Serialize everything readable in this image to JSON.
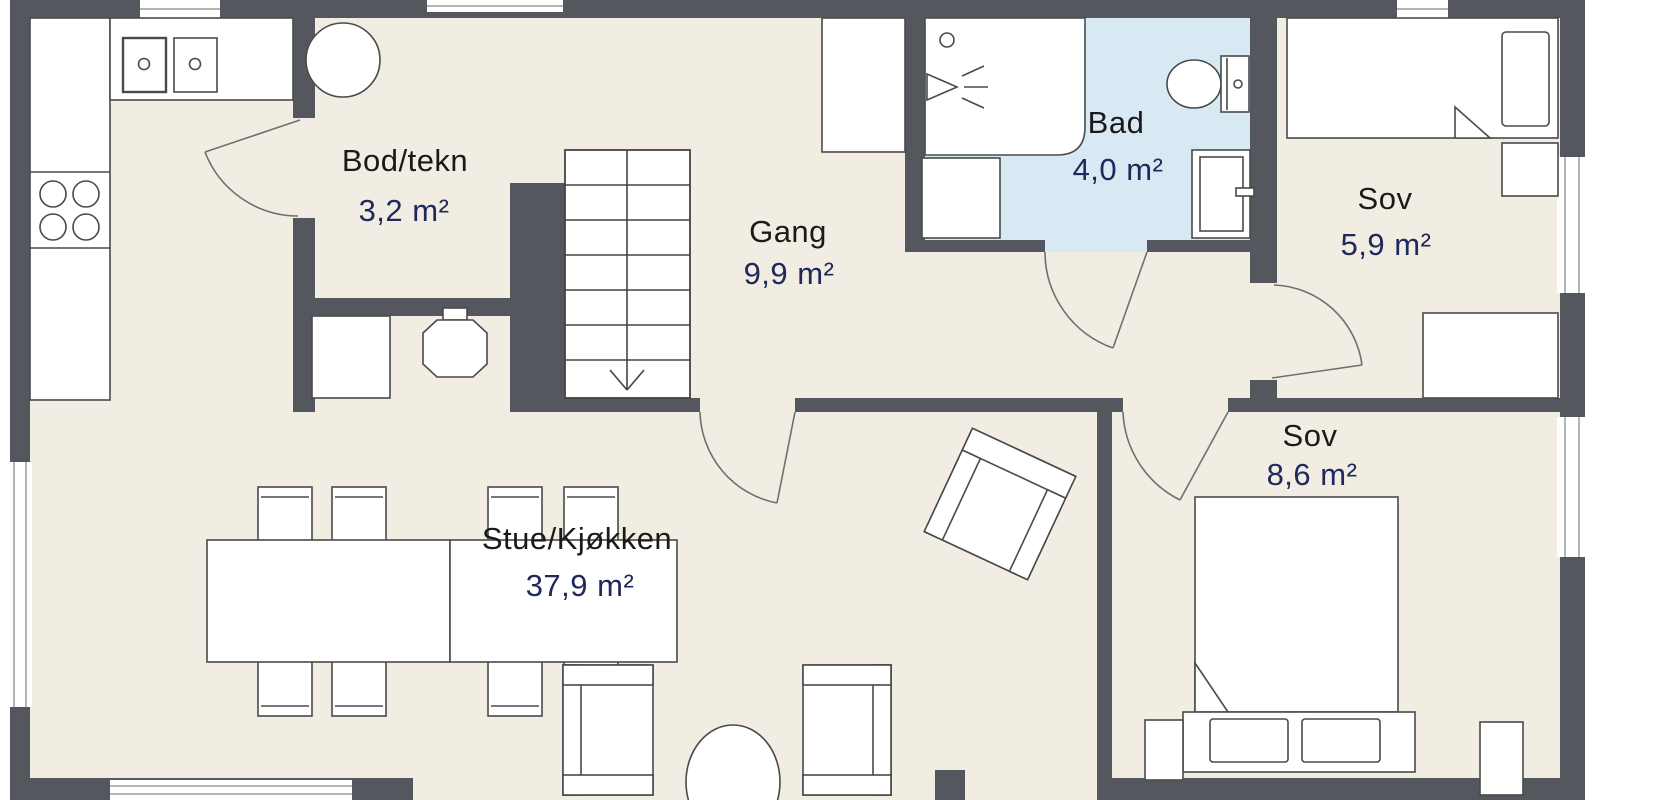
{
  "plan_type": "apartment-floor-plan",
  "rooms": [
    {
      "id": "bod",
      "name": "Bod/tekn",
      "area": "3,2 m²"
    },
    {
      "id": "gang",
      "name": "Gang",
      "area": "9,9 m²"
    },
    {
      "id": "bad",
      "name": "Bad",
      "area": "4,0 m²"
    },
    {
      "id": "sov1",
      "name": "Sov",
      "area": "5,9 m²"
    },
    {
      "id": "sov2",
      "name": "Sov",
      "area": "8,6 m²"
    },
    {
      "id": "stue",
      "name": "Stue/Kjøkken",
      "area": "37,9 m²"
    }
  ],
  "colors": {
    "wall": "#54575d",
    "floor": "#f2ede2",
    "bathroom_floor": "#d8e9f4",
    "furniture_fill": "#ffffff",
    "furniture_outline": "#4a4a4a",
    "room_name_text": "#1a1a1a",
    "room_area_text": "#20295c"
  },
  "fixtures": [
    "kitchen-counter",
    "kitchen-double-sink",
    "stove-burners",
    "water-tank",
    "washing-machine",
    "boiler",
    "staircase-with-down-arrow",
    "hall-wardrobe",
    "shower-cabin",
    "toilet",
    "bathroom-vanity",
    "single-bed",
    "nightstand",
    "desk",
    "double-bed",
    "pillows",
    "dining-table",
    "dining-chairs",
    "rotated-armchair",
    "lounge-chairs",
    "oval-coffee-table",
    "windows",
    "door-swings"
  ]
}
